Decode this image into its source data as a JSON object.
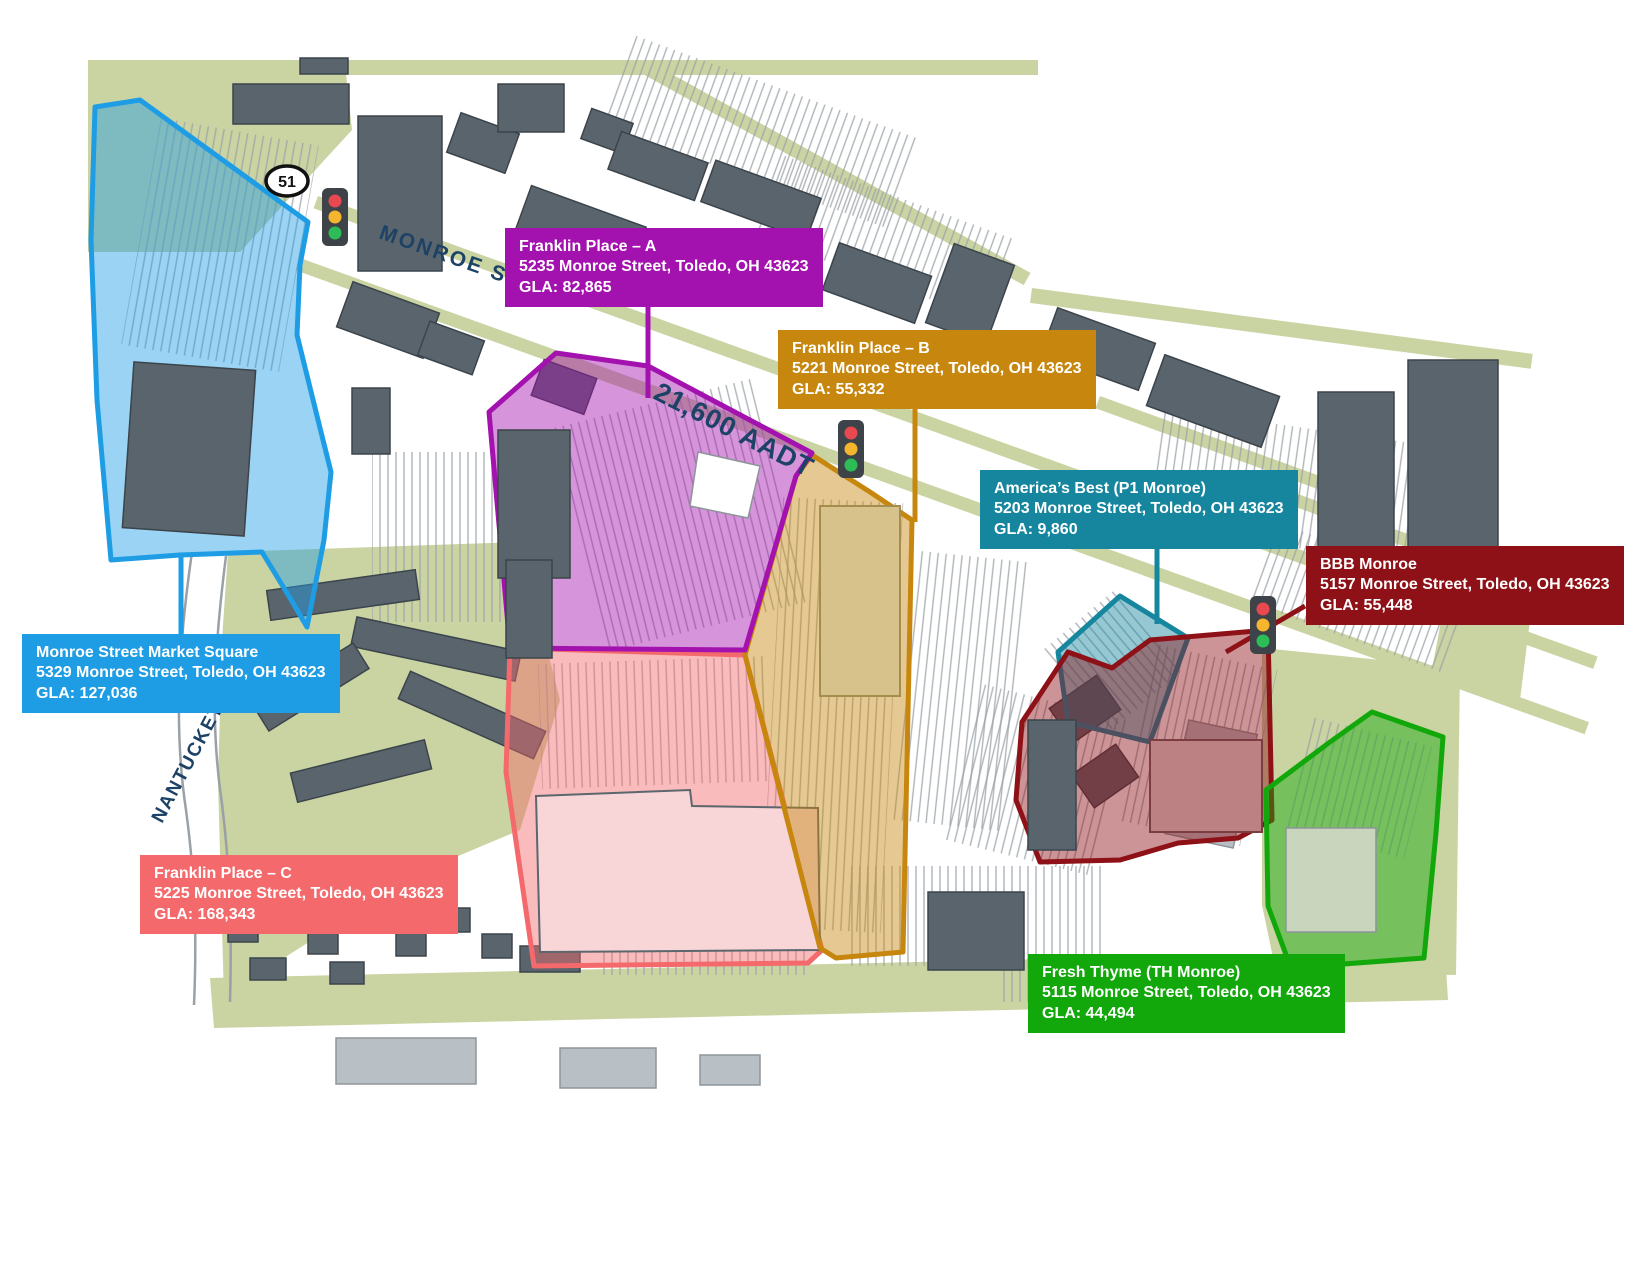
{
  "map": {
    "street_labels": {
      "monroe_st": "MONROE ST",
      "nantuckett_dr": "NANTUCKETT DR",
      "aadt": "21,600 AADT",
      "route_shield": "51"
    },
    "colors": {
      "street_label": "#1C4266",
      "greenery": "#CAD3A2",
      "building": "#5A646C"
    },
    "properties": [
      {
        "id": "monroe-street-market-square",
        "name": "Monroe Street Market Square",
        "address": "5329 Monroe Street, Toledo, OH 43623",
        "gla": "GLA: 127,036",
        "color": "#1E9DE5"
      },
      {
        "id": "franklin-place-a",
        "name": "Franklin Place – A",
        "address": "5235 Monroe Street, Toledo, OH 43623",
        "gla": "GLA: 82,865",
        "color": "#A312AE"
      },
      {
        "id": "franklin-place-b",
        "name": "Franklin Place – B",
        "address": "5221 Monroe Street, Toledo, OH 43623",
        "gla": "GLA: 55,332",
        "color": "#C7870E"
      },
      {
        "id": "americas-best-p1-monroe",
        "name": "America’s Best (P1 Monroe)",
        "address": "5203 Monroe Street, Toledo, OH 43623",
        "gla": "GLA: 9,860",
        "color": "#15869E"
      },
      {
        "id": "bbb-monroe",
        "name": "BBB Monroe",
        "address": "5157 Monroe Street, Toledo, OH 43623",
        "gla": "GLA: 55,448",
        "color": "#8E1117"
      },
      {
        "id": "franklin-place-c",
        "name": "Franklin Place – C",
        "address": "5225 Monroe Street, Toledo, OH 43623",
        "gla": "GLA: 168,343",
        "color": "#F4696B"
      },
      {
        "id": "fresh-thyme-th-monroe",
        "name": "Fresh Thyme (TH Monroe)",
        "address": "5115 Monroe Street, Toledo, OH 43623",
        "gla": "GLA: 44,494",
        "color": "#12A80B"
      }
    ]
  }
}
